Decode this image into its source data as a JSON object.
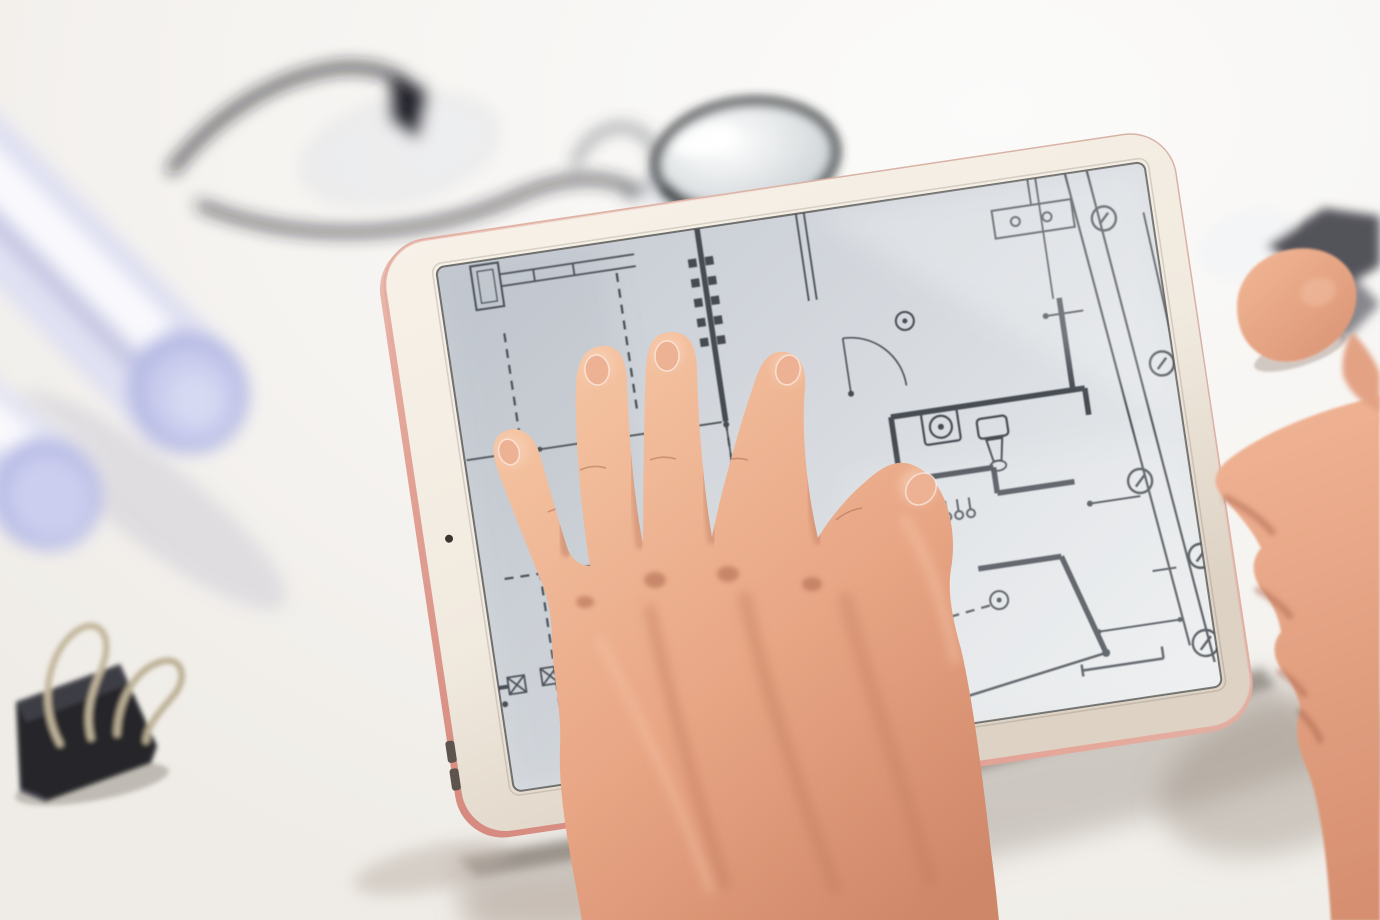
{
  "scene": {
    "caption": "Two hands using a rose-gold tablet that displays a black-and-white architectural floor plan blueprint, on a bright white desk beside two rolled blueprint tubes, blurred safety glasses, a dark-rimmed magnifying loupe and a black binder clip with silver wire handles.",
    "view": "overhead oblique close-up with shallow depth of field; tablet tilted diagonally, surrounding objects out of focus"
  },
  "objects": {
    "desk": {
      "name": "white desk surface"
    },
    "tablet": {
      "name": "rose-gold tablet with cream bezel",
      "screen_content": "architectural floor plan: solid walls, dashed reference lines, door swing arcs, washer and toilet fixture symbols, radiator dots, ceiling-light circles, hatched wall-section squares, twin slanted dimension lines with circled survey markers and tick lines",
      "camera": "front-camera dot on left bezel",
      "edge_buttons": "two dark buttons on lower-left edge",
      "edge_finish": "rose-gold rim visible along bottom-left edge"
    },
    "touching_hand": {
      "name": "hand touching the screen",
      "pose": "four spread fingers on the plan, thumb to the right, wrist at bottom center"
    },
    "gripping_hand": {
      "name": "hand gripping the right edge",
      "pose": "thumb over the top-right bezel, fingers wrapped around the bottom-right corner"
    },
    "rolled_blueprints": {
      "name": "rolled blueprint tubes",
      "count": 2,
      "tint": "pale lavender, heavily blurred, upper left"
    },
    "safety_glasses": {
      "name": "safety glasses",
      "state": "dark-framed, heavily blurred, top left"
    },
    "magnifier": {
      "name": "magnifying loupe lens",
      "state": "dark rim, partly hidden behind tablet top edge"
    },
    "binder_clip": {
      "name": "binder clip",
      "state": "black body, two raised silver wire handles, lower left"
    }
  },
  "colors": {
    "desk": "#f6f4f1",
    "desk-hi": "#fbfbfa",
    "frame": "#f1eadf",
    "frame-shade": "#ddd2c4",
    "rose": "#e5a99c",
    "rose-deep": "#d6897e",
    "screen-dark": "#c6cbd3",
    "screen-light": "#eceeef",
    "line": "#3b3f46",
    "skin-hi": "#f6c7a5",
    "skin-mid": "#e8a685",
    "skin-shadow": "#cf8769",
    "nail": "#edb193",
    "paper": "#e0e1f2",
    "paper-deep": "#b7bbe4",
    "clip-body": "#27272b",
    "clip-wire": "#c3b79d",
    "glasses": "#1e1f24"
  }
}
